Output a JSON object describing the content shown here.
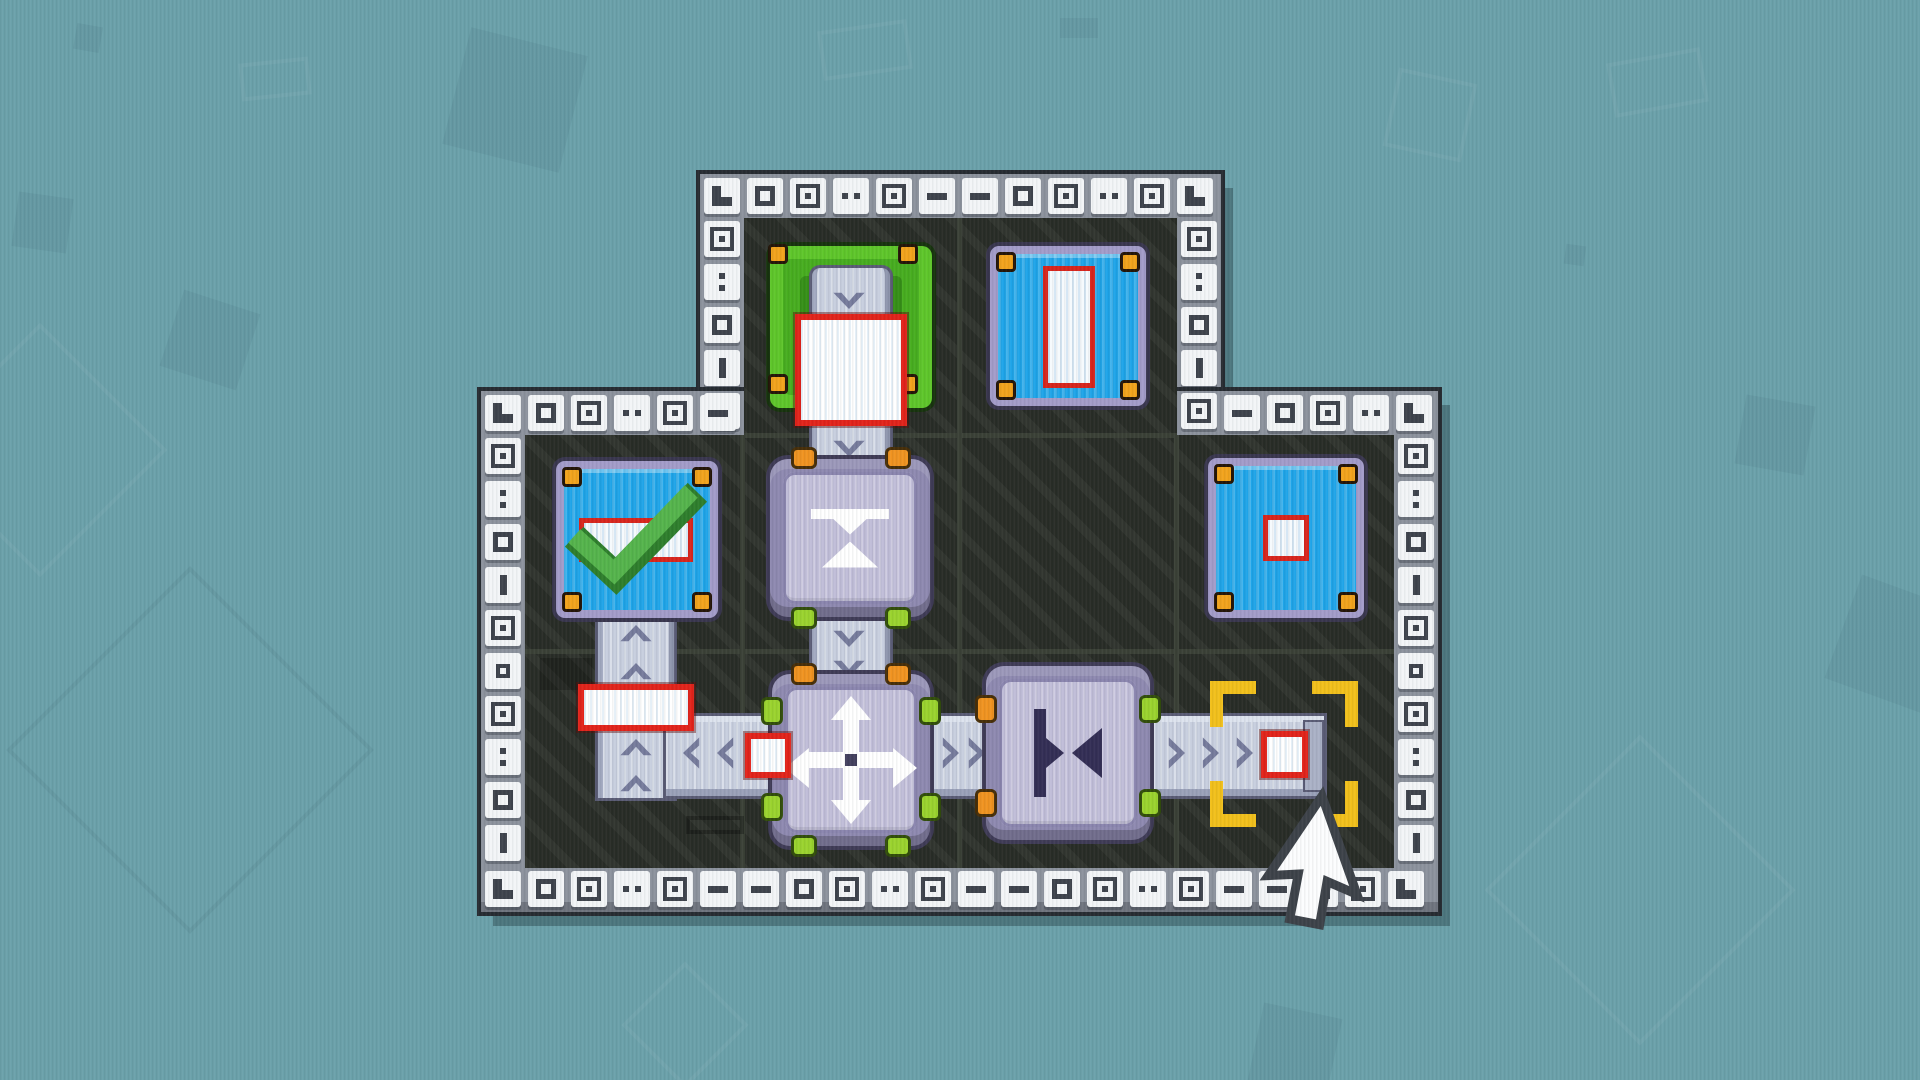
{
  "meta": {
    "app": "pixel-factory-puzzle",
    "screen": "level-board",
    "visible_text": "none"
  },
  "palette": {
    "background_teal": "#6ba1aa",
    "board_interior": "#282c26",
    "border_band": "#8c929d",
    "border_tile": "#f3f5f7",
    "border_glyph": "#3e434c",
    "belt_base": "#c7cede",
    "belt_chevron": "#767b9c",
    "machine_body": "#8e89b0",
    "machine_plate": "#c0bdd8",
    "machine_icon_dark": "#332e55",
    "goal_blue": "#1ea4e8",
    "goal_border_lavender": "#a39cc9",
    "goal_green_outer": "#5ec62a",
    "goal_green_inner": "#358f17",
    "bolt_orange": "#f2a31c",
    "box_fill": "#ffffff",
    "box_border_red": "#e2231a",
    "checkmark_green": "#55b44c",
    "bracket_yellow": "#f2c01b",
    "nub_orange": "#f09320",
    "nub_lime": "#9ad32e",
    "cursor_fill": "#fcfdfe",
    "cursor_outline": "#3d4249"
  },
  "board": {
    "shape": "main 4x2 grid with a 2-cell tab on top",
    "grid": {
      "cols": 4,
      "rows_main": 2,
      "tab_cols": [
        1,
        2
      ],
      "cell_size": 217
    },
    "border": {
      "glyphs_horizontal_cycle": [
        "dash",
        "sq",
        "sqdot",
        "dotsh",
        "sqdot",
        "dash"
      ],
      "glyphs_vertical_cycle": [
        "sqdot",
        "dotsv",
        "sq",
        "barv",
        "sqdot",
        "sqsm"
      ],
      "corner_glyph": "corner"
    },
    "goals": [
      {
        "id": "spawner-green",
        "row": 0,
        "col": 1,
        "style": "green",
        "holds": "large-square-box"
      },
      {
        "id": "goal-tall-rect",
        "row": 0,
        "col": 2,
        "style": "blue",
        "icon": "tall-rectangle"
      },
      {
        "id": "goal-wide-rect",
        "row": 1,
        "col": 0,
        "style": "blue",
        "icon": "wide-rectangle",
        "status": "completed",
        "badge": "green-checkmark"
      },
      {
        "id": "goal-small-square",
        "row": 1,
        "col": 3,
        "style": "blue",
        "icon": "small-square"
      }
    ],
    "machines": [
      {
        "id": "press-vertical",
        "row": 1,
        "col": 1,
        "icon": "squash-vertical",
        "nubs": {
          "top": "orange",
          "bottom": "lime"
        }
      },
      {
        "id": "mover",
        "row": 2,
        "col": 1,
        "icon": "arrows-four-way",
        "nubs": {
          "top": "orange",
          "bottom": "lime",
          "left": "lime",
          "right": "lime"
        }
      },
      {
        "id": "press-horizontal",
        "row": 2,
        "col": 2,
        "icon": "squash-horizontal",
        "nubs": {
          "left": "orange",
          "right": "lime"
        }
      }
    ],
    "belts": [
      {
        "id": "belt-spawner-down",
        "from": "spawner-green",
        "to": "press-vertical",
        "direction": "down"
      },
      {
        "id": "belt-press-to-mover",
        "from": "press-vertical",
        "to": "mover",
        "direction": "down"
      },
      {
        "id": "belt-left",
        "from": "mover",
        "to": "goal-wide-rect",
        "direction": "left-then-up"
      },
      {
        "id": "belt-right-1",
        "from": "mover",
        "to": "press-horizontal",
        "direction": "right"
      },
      {
        "id": "belt-right-2",
        "from": "press-horizontal",
        "to": "target-cell",
        "direction": "right"
      }
    ],
    "boxes": [
      {
        "id": "box-large",
        "shape": "square",
        "location": "on spawner-green"
      },
      {
        "id": "box-wide",
        "shape": "wide-rectangle",
        "location": "on belt-left vertical run"
      },
      {
        "id": "box-small-left",
        "shape": "small-square",
        "location": "on belt-left beside mover"
      },
      {
        "id": "box-small-right",
        "shape": "small-square",
        "location": "on belt-right-2 inside target brackets"
      }
    ],
    "selection": {
      "id": "target-brackets",
      "row": 2,
      "col": 3,
      "style": "yellow-corner-brackets"
    }
  },
  "cursor": {
    "style": "pixel-arrow",
    "tip_x": 1322,
    "tip_y": 798
  }
}
